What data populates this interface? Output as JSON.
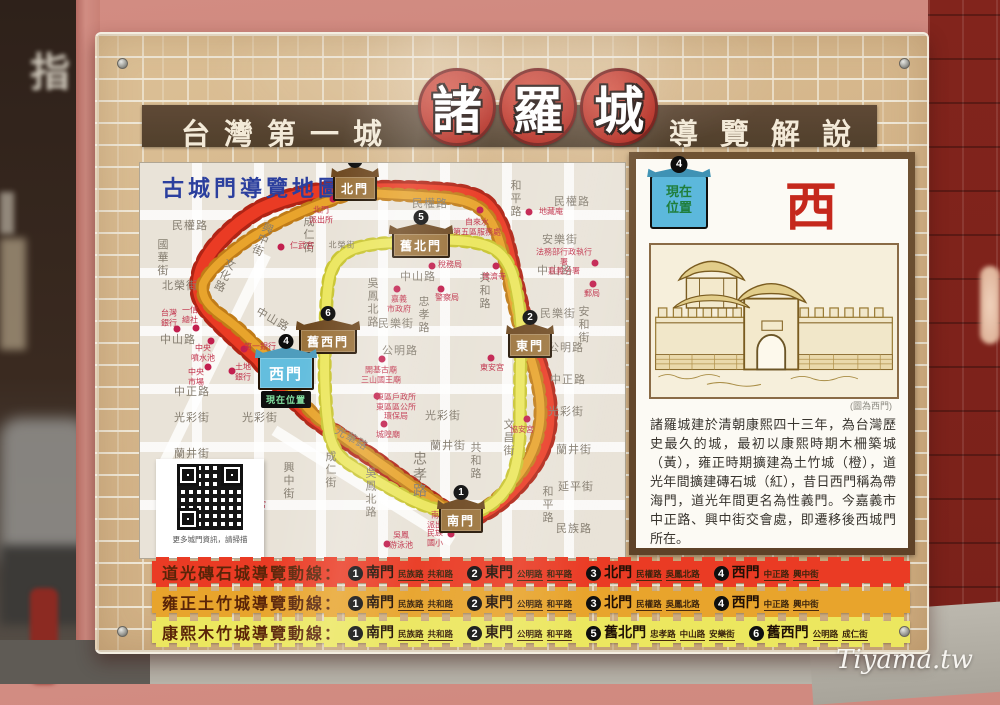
{
  "watermark": "Tiyama.tw",
  "background": {
    "left_sign_char": "指"
  },
  "colors": {
    "route_red": "#ea3b24",
    "route_red_dark": "#b02415",
    "route_orange": "#e8a42c",
    "route_yellow": "#ece75f",
    "poi_red": "#c21f4e",
    "map_title_blue": "#2b3f9e",
    "panel_title_red": "#c5281c"
  },
  "sign": {
    "title": {
      "left": "台灣第一城",
      "seals": [
        {
          "ch": "諸"
        },
        {
          "ch": "羅"
        },
        {
          "ch": "城"
        }
      ],
      "right": "導覽解說"
    },
    "map": {
      "title": "古城門導覽地圖",
      "qr_caption": "更多城門資訊，請掃描",
      "paths": {
        "daoguang": "M215,27 C185,25 150,32 120,46 C92,62 70,85 62,105 C56,122 58,135 68,148 C80,162 100,180 118,196 C132,214 152,236 172,254 C196,272 218,284 242,302 C264,318 292,338 315,354 Q322,358 331,355 C346,350 359,341 372,328 C389,311 403,291 407,269 C411,247 407,225 397,197 Q392,186 389,178 C383,158 377,129 371,102 C366,78 361,58 349,44 C339,32 319,29 297,28 C269,26 240,26 215,27 Z",
        "yongzheng": "M215,29 C180,40 140,56 108,77 C85,93 68,109 63,121 C61,133 67,142 81,152 C97,163 113,178 130,197 C143,213 158,238 179,256 C201,273 223,288 247,305 C268,320 293,338 315,351 Q322,354 331,351 C346,346 358,336 370,322 C385,306 395,288 399,266 C403,244 399,222 391,196 Q387,186 383,176 C377,156 371,128 366,103 C361,81 356,63 346,51 C336,39 318,35 296,34 C268,32 240,31 215,29 Z",
        "kangxi": "M281,82 C262,79 240,79 220,84 C204,88 194,98 190,112 C186,128 186,150 185,180 C184,210 185,240 188,262 C190,280 196,292 208,300 C220,308 240,320 262,332 C284,344 305,350 322,351 Q331,352 341,347 C355,341 366,329 372,315 C378,299 380,279 380,257 C380,229 380,204 381,184 C382,164 380,144 375,121 C371,103 364,91 352,85 C340,79 320,77 302,77 Q290,78 281,82 Z"
      },
      "gates": [
        {
          "num": "3",
          "t": "北門",
          "x": 215,
          "y": 25
        },
        {
          "num": "5",
          "t": "舊北門",
          "x": 281,
          "y": 82
        },
        {
          "num": "2",
          "t": "東門",
          "x": 390,
          "y": 182
        },
        {
          "num": "6",
          "t": "舊西門",
          "x": 188,
          "y": 178
        },
        {
          "num": "1",
          "t": "南門",
          "x": 321,
          "y": 357
        },
        {
          "num": "4",
          "t": "西門",
          "x": 146,
          "y": 210,
          "cls": "blue",
          "loc": "現在位置"
        }
      ],
      "streets": [
        {
          "t": "民權路",
          "x": 50,
          "y": 62
        },
        {
          "t": "國華街",
          "x": 22,
          "y": 95,
          "cls": "v"
        },
        {
          "t": "北榮街",
          "x": 40,
          "y": 122
        },
        {
          "t": "文化路",
          "x": 84,
          "y": 112,
          "cls": "dv"
        },
        {
          "t": "興中街",
          "x": 122,
          "y": 76,
          "cls": "dv"
        },
        {
          "t": "成仁街",
          "x": 168,
          "y": 72,
          "cls": "v"
        },
        {
          "t": "北榮街",
          "x": 202,
          "y": 82,
          "cls": "s"
        },
        {
          "t": "民權路",
          "x": 290,
          "y": 40
        },
        {
          "t": "和平路",
          "x": 375,
          "y": 36,
          "cls": "v"
        },
        {
          "t": "民權路",
          "x": 432,
          "y": 38
        },
        {
          "t": "安樂街",
          "x": 420,
          "y": 76
        },
        {
          "t": "中山路",
          "x": 415,
          "y": 107
        },
        {
          "t": "中山路",
          "x": 278,
          "y": 113
        },
        {
          "t": "共和路",
          "x": 344,
          "y": 128,
          "cls": "v"
        },
        {
          "t": "忠孝路",
          "x": 283,
          "y": 152,
          "cls": "v"
        },
        {
          "t": "吳鳳北路",
          "x": 232,
          "y": 140,
          "cls": "v"
        },
        {
          "t": "民樂街",
          "x": 256,
          "y": 160
        },
        {
          "t": "民樂街",
          "x": 418,
          "y": 150
        },
        {
          "t": "安和街",
          "x": 443,
          "y": 162,
          "cls": "v"
        },
        {
          "t": "公明路",
          "x": 426,
          "y": 184
        },
        {
          "t": "公明路",
          "x": 260,
          "y": 187
        },
        {
          "t": "中山路",
          "x": 38,
          "y": 176
        },
        {
          "t": "中山路",
          "x": 133,
          "y": 156,
          "cls": "d"
        },
        {
          "t": "中正路",
          "x": 52,
          "y": 228
        },
        {
          "t": "中正路",
          "x": 428,
          "y": 216
        },
        {
          "t": "光彩街",
          "x": 52,
          "y": 254
        },
        {
          "t": "光彩街",
          "x": 120,
          "y": 254
        },
        {
          "t": "光彩街",
          "x": 303,
          "y": 252
        },
        {
          "t": "光彩街",
          "x": 426,
          "y": 248
        },
        {
          "t": "蘭井街",
          "x": 52,
          "y": 290
        },
        {
          "t": "蘭井街",
          "x": 308,
          "y": 282
        },
        {
          "t": "蘭井街",
          "x": 434,
          "y": 286
        },
        {
          "t": "忠孝路",
          "x": 280,
          "y": 312,
          "cls": "v lg"
        },
        {
          "t": "共和路",
          "x": 335,
          "y": 298,
          "cls": "v"
        },
        {
          "t": "文昌街",
          "x": 368,
          "y": 275,
          "cls": "v"
        },
        {
          "t": "延平街",
          "x": 436,
          "y": 323
        },
        {
          "t": "和平路",
          "x": 407,
          "y": 342,
          "cls": "v"
        },
        {
          "t": "民族路",
          "x": 434,
          "y": 365
        },
        {
          "t": "吳鳳北路",
          "x": 230,
          "y": 330,
          "cls": "v"
        },
        {
          "t": "光華路",
          "x": 212,
          "y": 275,
          "cls": "d"
        },
        {
          "t": "興中街",
          "x": 148,
          "y": 318,
          "cls": "v"
        },
        {
          "t": "成仁街",
          "x": 190,
          "y": 307,
          "cls": "v"
        }
      ],
      "pois": [
        {
          "t": "北門\n派出所",
          "x": 193,
          "y": 36,
          "lx": 181,
          "ly": 52
        },
        {
          "t": "仁武宮",
          "x": 141,
          "y": 84,
          "lx": 162,
          "ly": 83
        },
        {
          "t": "自來水\n第五區服務處",
          "x": 340,
          "y": 47,
          "lx": 337,
          "ly": 64
        },
        {
          "t": "地藏庵",
          "x": 389,
          "y": 49,
          "lx": 411,
          "ly": 49
        },
        {
          "t": "法務部行政執行署\n嘉義分署",
          "x": 455,
          "y": 100,
          "lx": 424,
          "ly": 99
        },
        {
          "t": "郵局",
          "x": 453,
          "y": 121,
          "lx": 452,
          "ly": 131
        },
        {
          "t": "稅務局",
          "x": 292,
          "y": 103,
          "lx": 310,
          "ly": 102
        },
        {
          "t": "普濟寺",
          "x": 356,
          "y": 103,
          "lx": 354,
          "ly": 114
        },
        {
          "t": "嘉義\n市政府",
          "x": 257,
          "y": 126,
          "lx": 259,
          "ly": 141
        },
        {
          "t": "警察局",
          "x": 301,
          "y": 126,
          "lx": 307,
          "ly": 135
        },
        {
          "t": "東安宮",
          "x": 351,
          "y": 195,
          "lx": 352,
          "ly": 205
        },
        {
          "t": "開基古廟\n三山國王廟",
          "x": 242,
          "y": 196,
          "lx": 241,
          "ly": 212
        },
        {
          "t": "東區戶政所\n東區區公所\n環保局",
          "x": 237,
          "y": 233,
          "lx": 256,
          "ly": 244
        },
        {
          "t": "城隍廟",
          "x": 244,
          "y": 261,
          "lx": 248,
          "ly": 272
        },
        {
          "t": "協安宮",
          "x": 387,
          "y": 256,
          "lx": 382,
          "ly": 267
        },
        {
          "t": "鎮安宮",
          "x": 115,
          "y": 353,
          "lx": 114,
          "ly": 342
        },
        {
          "t": "南門\n派出所",
          "x": 316,
          "y": 356,
          "lx": 299,
          "ly": 357
        },
        {
          "t": "吳鳳\n游泳池",
          "x": 247,
          "y": 381,
          "lx": 261,
          "ly": 377
        },
        {
          "t": "民族\n國小",
          "x": 311,
          "y": 371,
          "lx": 295,
          "ly": 375
        },
        {
          "t": "台灣\n銀行",
          "x": 37,
          "y": 166,
          "lx": 29,
          "ly": 155
        },
        {
          "t": "一信\n總社",
          "x": 56,
          "y": 165,
          "lx": 50,
          "ly": 152
        },
        {
          "t": "中央\n噴水池",
          "x": 71,
          "y": 178,
          "lx": 63,
          "ly": 190
        },
        {
          "t": "中央\n市場",
          "x": 68,
          "y": 204,
          "lx": 56,
          "ly": 214
        },
        {
          "t": "土地\n銀行",
          "x": 92,
          "y": 208,
          "lx": 103,
          "ly": 209
        },
        {
          "t": "第一銀行",
          "x": 104,
          "y": 186,
          "lx": 120,
          "ly": 184
        }
      ]
    },
    "panel": {
      "num": "4",
      "current_label": "現在\n位置",
      "title": "西門",
      "caption": "(圖為西門)",
      "body": "諸羅城建於清朝康熙四十三年，為台灣歷史最久的城，最初以康熙時期木柵築城（黃），雍正時期擴建為土竹城（橙），道光年間擴建磚石城（紅），昔日西門稱為帶海門，道光年間更名為性義門。今嘉義市中正路、興中街交會處，即遷移後西城門所在。"
    },
    "routes": [
      {
        "label": "道光磚石城導覽動線：",
        "stops": [
          {
            "n": "1",
            "g": "南門",
            "streets": [
              "民族路",
              "共和路"
            ]
          },
          {
            "n": "2",
            "g": "東門",
            "streets": [
              "公明路",
              "和平路"
            ]
          },
          {
            "n": "3",
            "g": "北門",
            "streets": [
              "民權路",
              "吳鳳北路"
            ]
          },
          {
            "n": "4",
            "g": "西門",
            "streets": [
              "中正路",
              "興中街"
            ]
          }
        ]
      },
      {
        "label": "雍正土竹城導覽動線：",
        "stops": [
          {
            "n": "1",
            "g": "南門",
            "streets": [
              "民族路",
              "共和路"
            ]
          },
          {
            "n": "2",
            "g": "東門",
            "streets": [
              "公明路",
              "和平路"
            ]
          },
          {
            "n": "3",
            "g": "北門",
            "streets": [
              "民權路",
              "吳鳳北路"
            ]
          },
          {
            "n": "4",
            "g": "西門",
            "streets": [
              "中正路",
              "興中街"
            ]
          }
        ]
      },
      {
        "label": "康熙木竹城導覽動線：",
        "stops": [
          {
            "n": "1",
            "g": "南門",
            "streets": [
              "民族路",
              "共和路"
            ]
          },
          {
            "n": "2",
            "g": "東門",
            "streets": [
              "公明路",
              "和平路"
            ]
          },
          {
            "n": "5",
            "g": "舊北門",
            "streets": [
              "忠孝路",
              "中山路",
              "安樂街"
            ]
          },
          {
            "n": "6",
            "g": "舊西門",
            "streets": [
              "公明路",
              "成仁街"
            ]
          }
        ]
      }
    ]
  }
}
